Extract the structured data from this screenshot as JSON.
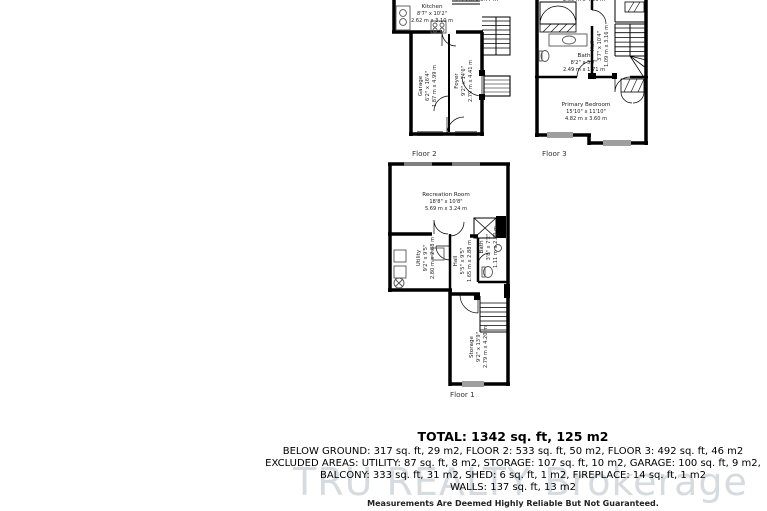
{
  "floors": {
    "floor2": {
      "label": "Floor 2",
      "cut_dimension_top": "2.79 m x 3.77 m",
      "rooms": {
        "kitchen": {
          "name": "Kitchen",
          "imperial": "8'7\" x 10'2\"",
          "metric": "2.62 m x 3.10 m"
        },
        "garage": {
          "name": "Garage",
          "imperial": "6'2\" x 16'4\"",
          "metric": "1.87 m x 4.99 m"
        },
        "foyer": {
          "name": "Foyer",
          "imperial": "9'2\" x 14'6\"",
          "metric": "2.79 m x 4.41 m"
        }
      }
    },
    "floor3": {
      "label": "Floor 3",
      "cut_dimension_top": "2.69 m x 4.23 m",
      "rooms": {
        "bath": {
          "name": "Bath",
          "imperial": "8'2\" x 5'7\"",
          "metric": "2.49 m x 1.71 m"
        },
        "hall": {
          "name": "Hall",
          "imperial": "3'7\" x 10'4\"",
          "metric": "1.09 m x 3.16 m"
        },
        "primary_bedroom": {
          "name": "Primary Bedroom",
          "imperial": "15'10\" x 11'10\"",
          "metric": "4.82 m x 3.60 m"
        }
      }
    },
    "floor1": {
      "label": "Floor 1",
      "rooms": {
        "recreation": {
          "name": "Recreation Room",
          "imperial": "18'8\" x 10'8\"",
          "metric": "5.69 m x 3.24 m"
        },
        "utility": {
          "name": "Utility",
          "imperial": "9'2\" x 9'5\"",
          "metric": "2.80 m x 2.88 m"
        },
        "hall": {
          "name": "Hall",
          "imperial": "5'5\" x 9'5\"",
          "metric": "1.65 m x 2.88 m"
        },
        "bath": {
          "name": "Bath",
          "imperial": "3'8\" x 7'2\"",
          "metric": "1.11 m x 2.20 m"
        },
        "storage": {
          "name": "Storage",
          "imperial": "9'2\" x 13'9\"",
          "metric": "2.79 m x 4.20 m"
        }
      }
    }
  },
  "summary": {
    "total": "TOTAL: 1342 sq. ft, 125 m2",
    "lines": [
      "BELOW GROUND: 317 sq. ft, 29 m2, FLOOR 2: 533 sq. ft, 50 m2, FLOOR 3: 492 sq. ft, 46 m2",
      "EXCLUDED AREAS: UTILITY: 87 sq. ft, 8 m2, STORAGE: 107 sq. ft, 10 m2, GARAGE: 100 sq. ft, 9 m2,",
      "BALCONY: 333 sq. ft, 31 m2, SHED: 6 sq. ft, 1 m2, FIREPLACE: 14 sq. ft, 1 m2",
      "WALLS: 137 sq. ft, 13 m2"
    ],
    "disclaimer": "Measurements Are Deemed Highly Reliable But Not Guaranteed."
  },
  "watermark": "TRU REALTY Brokerage"
}
